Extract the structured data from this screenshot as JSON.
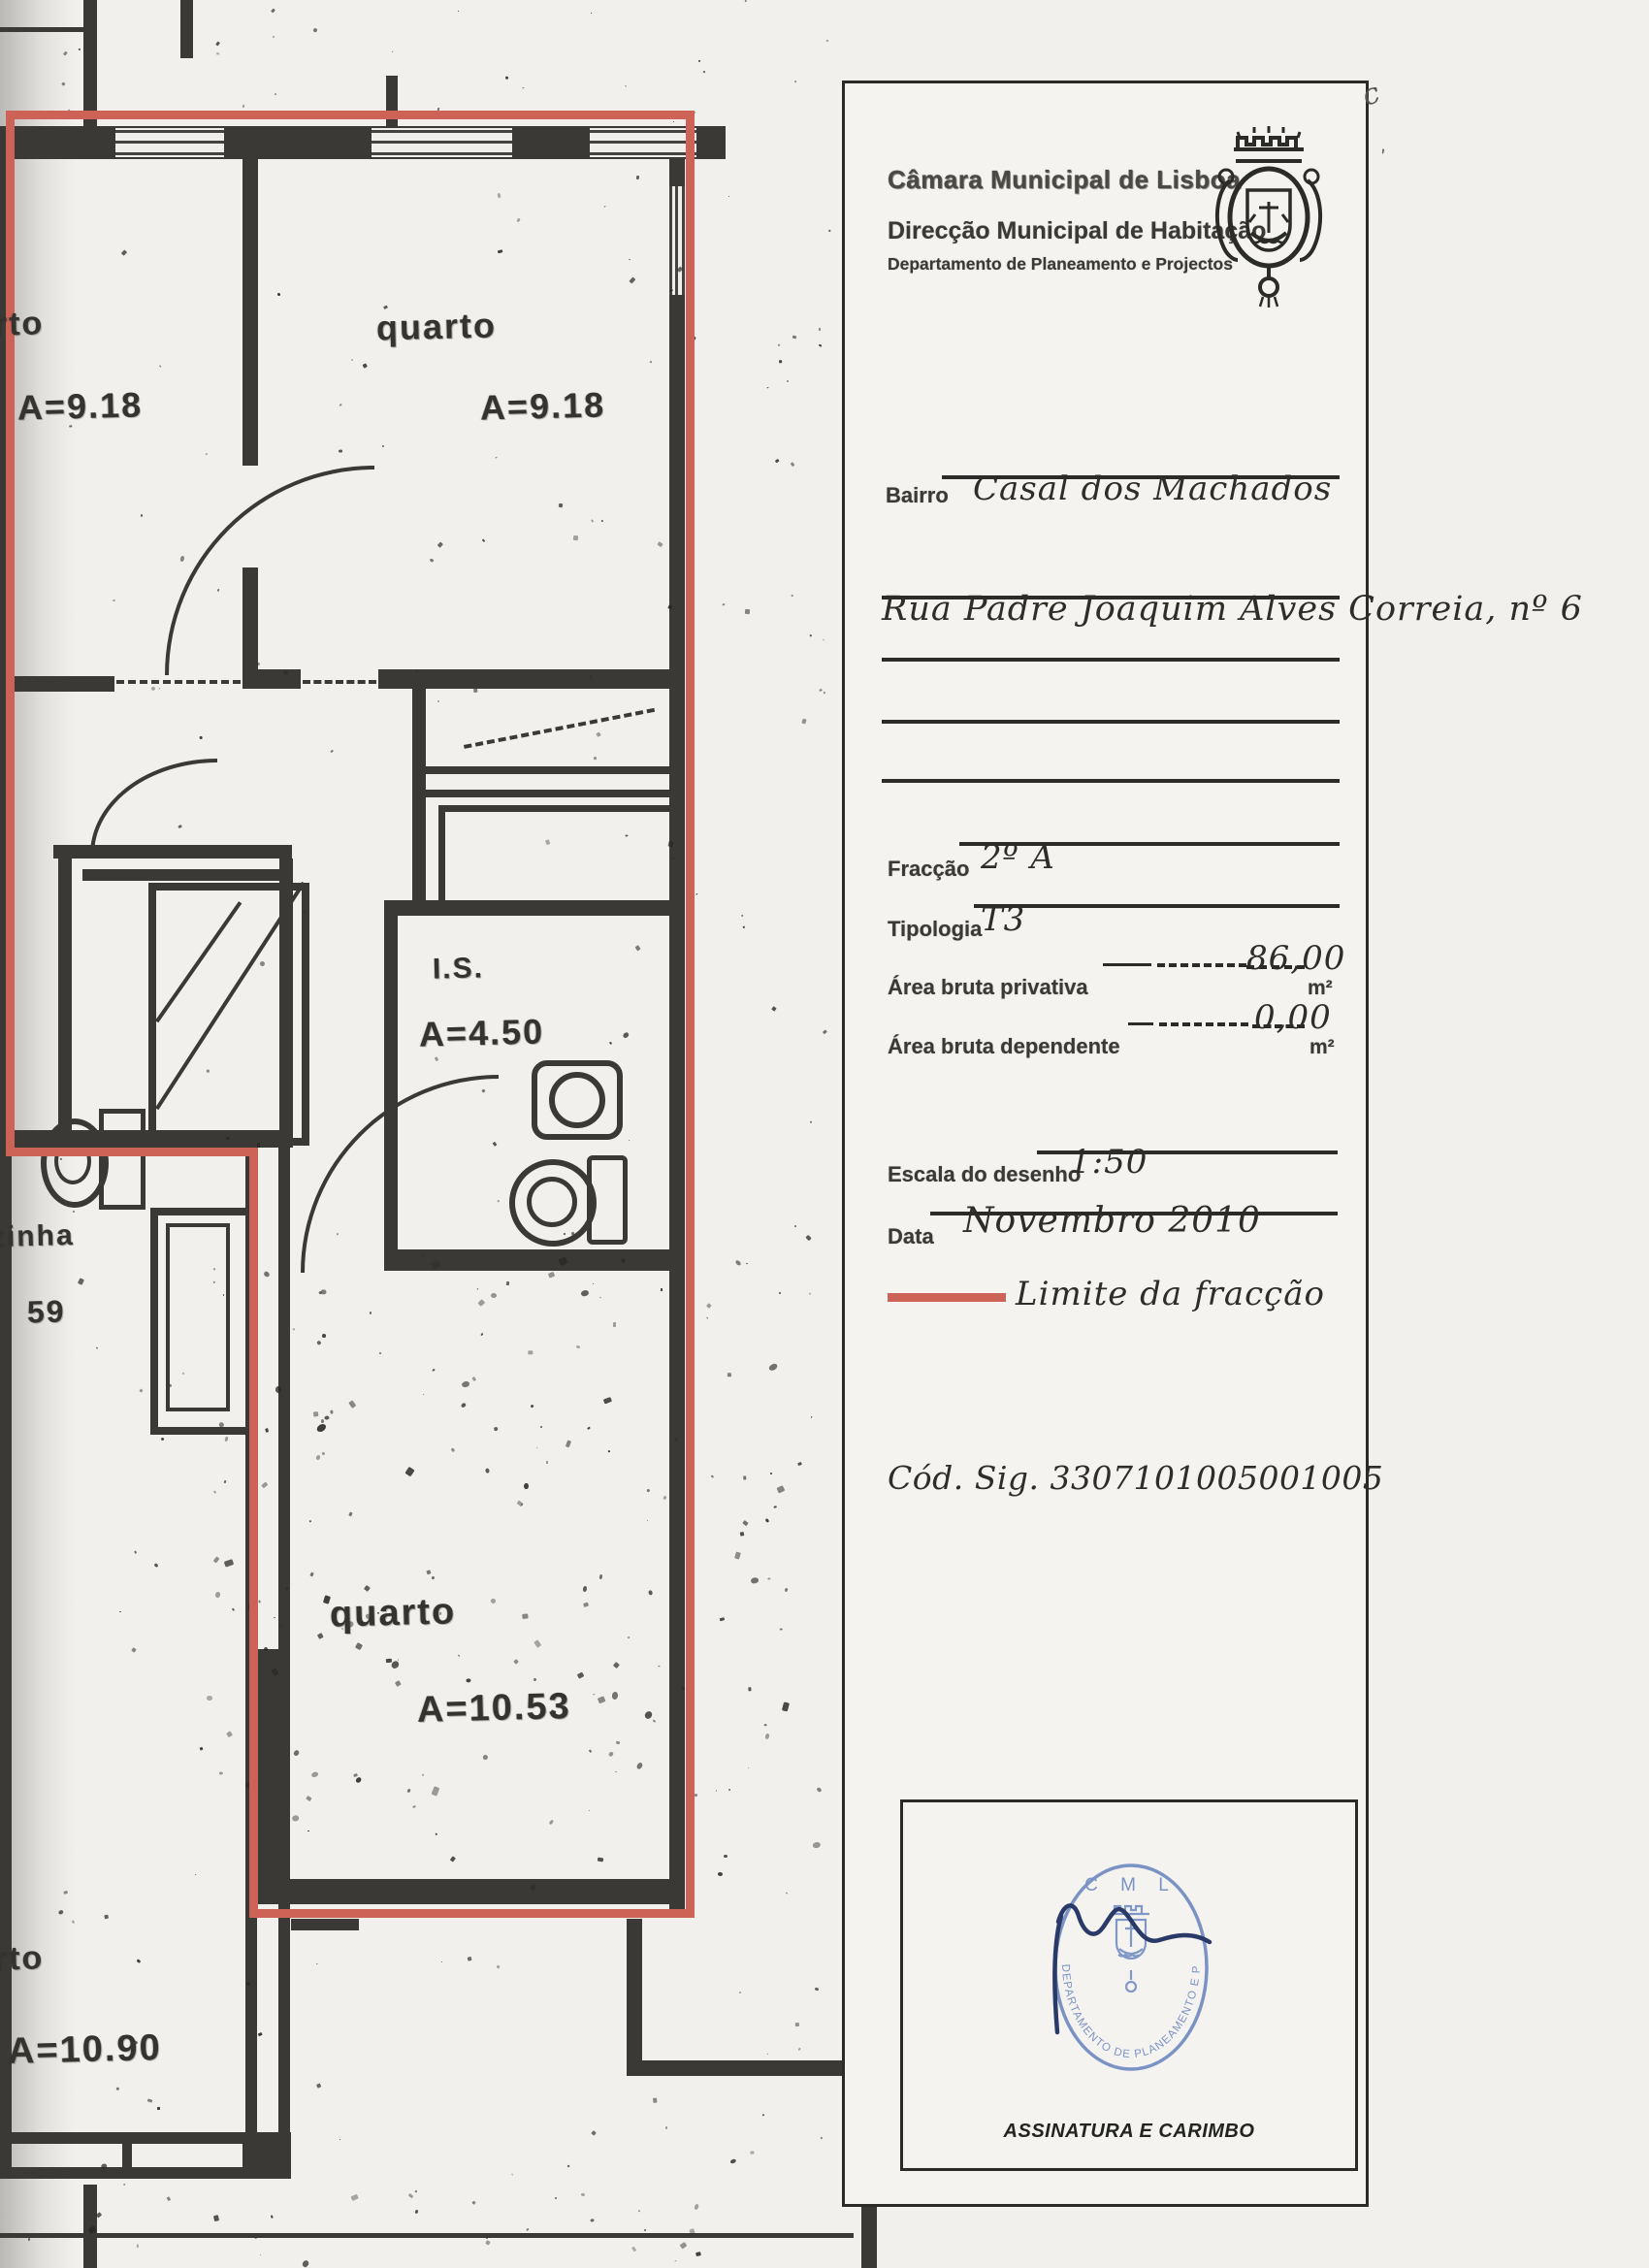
{
  "header": {
    "line1": "Câmara Municipal de Lisboa",
    "line2": "Direcção Municipal de Habitação",
    "line3": "Departamento de Planeamento e Projectos"
  },
  "fields": {
    "bairro_label": "Bairro",
    "bairro_value": "Casal dos Machados",
    "address_value": "Rua Padre Joaquim Alves Correia, nº 6",
    "fraccao_label": "Fracção",
    "fraccao_value": "2º A",
    "tipologia_label": "Tipologia",
    "tipologia_value": "T3",
    "area_privativa_label": "Área bruta privativa",
    "area_privativa_value": "86,00",
    "area_privativa_unit": "m²",
    "area_dependente_label": "Área bruta dependente",
    "area_dependente_value": "0,00",
    "area_dependente_unit": "m²",
    "escala_label": "Escala do desenho",
    "escala_value": "1:50",
    "data_label": "Data",
    "data_value": "Novembro 2010",
    "legend_label": "Limite da fracção",
    "cod_sig": "Cód. Sig. 3307101005001005"
  },
  "signature": {
    "caption": "ASSINATURA E CARIMBO",
    "stamp_top": "C M L",
    "stamp_ring": "DEPARTAMENTO DE PLANEAMENTO E PROJECTOS"
  },
  "plan": {
    "bedroom_top_left": {
      "label": "rto",
      "area": "A=9.18"
    },
    "bedroom_top": {
      "label": "quarto",
      "area": "A=9.18"
    },
    "bathroom": {
      "label": "I.S.",
      "area": "A=4.50"
    },
    "bedroom_bottom": {
      "label": "quarto",
      "area": "A=10.53"
    },
    "kitchen_cut": {
      "label": "zinha",
      "area": "59"
    },
    "bedroom_left": {
      "label": "rto",
      "area": "A=10.90"
    }
  },
  "annotations": {
    "pen_mark": "c"
  },
  "colors": {
    "boundary_red": "#cd6257",
    "stamp_blue": "#7b93c4",
    "signature_ink": "#2a3a68"
  }
}
